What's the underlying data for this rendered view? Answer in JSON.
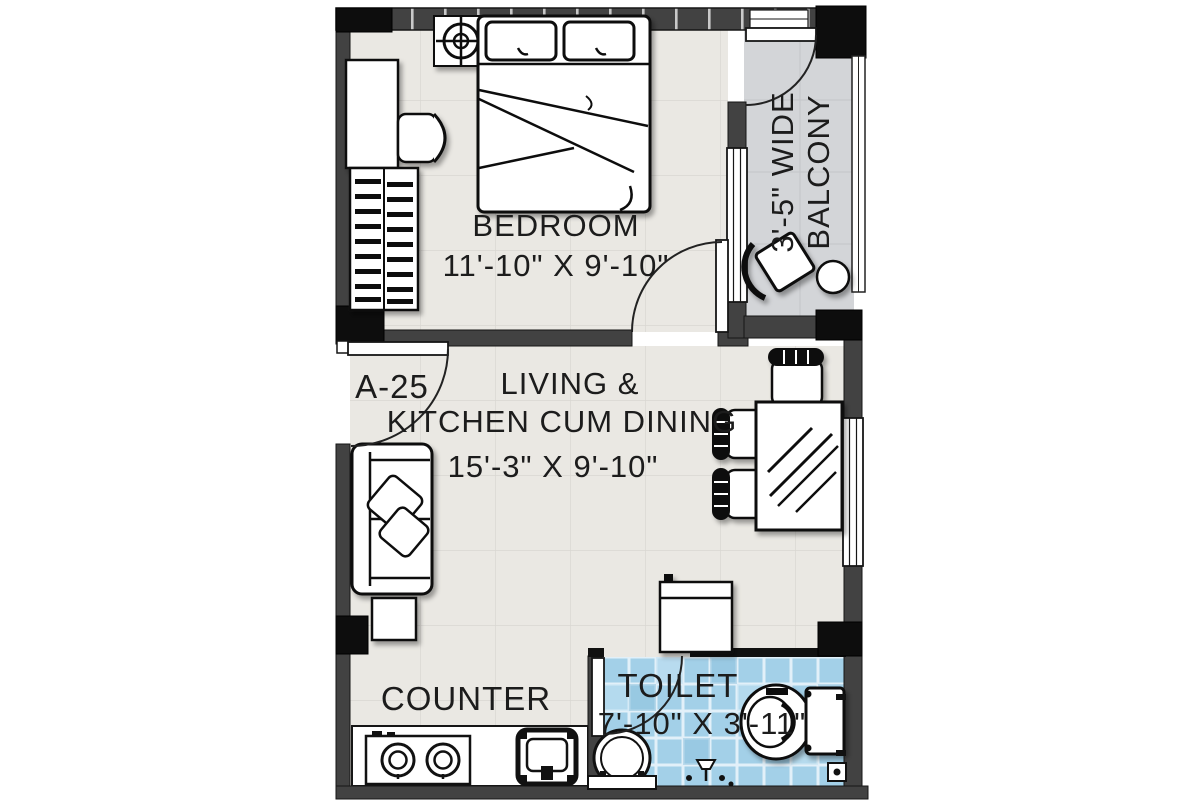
{
  "plan_title": "1 BHK apartment floor plan",
  "rooms": {
    "bedroom": {
      "name": "BEDROOM",
      "size": "11'-10\" X 9'-10\""
    },
    "living": {
      "name_line1": "LIVING &",
      "name_line2": "KITCHEN CUM DINING",
      "size": "15'-3\" X 9'-10\""
    },
    "toilet": {
      "name": "TOILET",
      "size": "7'-10\" X 3'-11\""
    },
    "balcony": {
      "name_line1": "3'-5\" WIDE",
      "name_line2": "BALCONY"
    },
    "kitchen_counter": {
      "name": "COUNTER"
    }
  },
  "entry_door": {
    "label": "A-25"
  },
  "colors": {
    "wall": "#424242",
    "wall_black": "#0d0d0d",
    "floor": "#eae8e3",
    "floor_grid_line": "#d9d7d2",
    "balcony_floor": "#d3d5d8",
    "toilet_tile": "#a3d0e8",
    "tile_grout": "#e9f4fb",
    "outline": "#161616",
    "furniture_fill": "#ffffff",
    "text": "#1c1c1c"
  },
  "symbols": {
    "double-bed-icon": "double bed with two pillows and folded blanket",
    "ceiling-fan-icon": "crosshair circle fan symbol",
    "wardrobe-icon": "hatched wardrobe",
    "study-table-icon": "table strip along wall",
    "desk-chair-icon": "chair with curved back",
    "sofa-icon": "two-seat sofa with cushions",
    "side-table-icon": "square side table",
    "dining-table-icon": "glass-top dining table",
    "dining-chair-icon": "chair with striped back",
    "refrigerator-icon": "fridge box",
    "gas-stove-icon": "two-burner hob",
    "kitchen-sink-icon": "square sink",
    "wash-basin-icon": "round basin",
    "water-closet-icon": "WC with tank",
    "floor-drain-icon": "floor trap",
    "balcony-chair-icon": "tilted chair",
    "balcony-table-icon": "round table",
    "door-swing-icon": "quarter-circle door swing",
    "window-icon": "triple-line window"
  }
}
